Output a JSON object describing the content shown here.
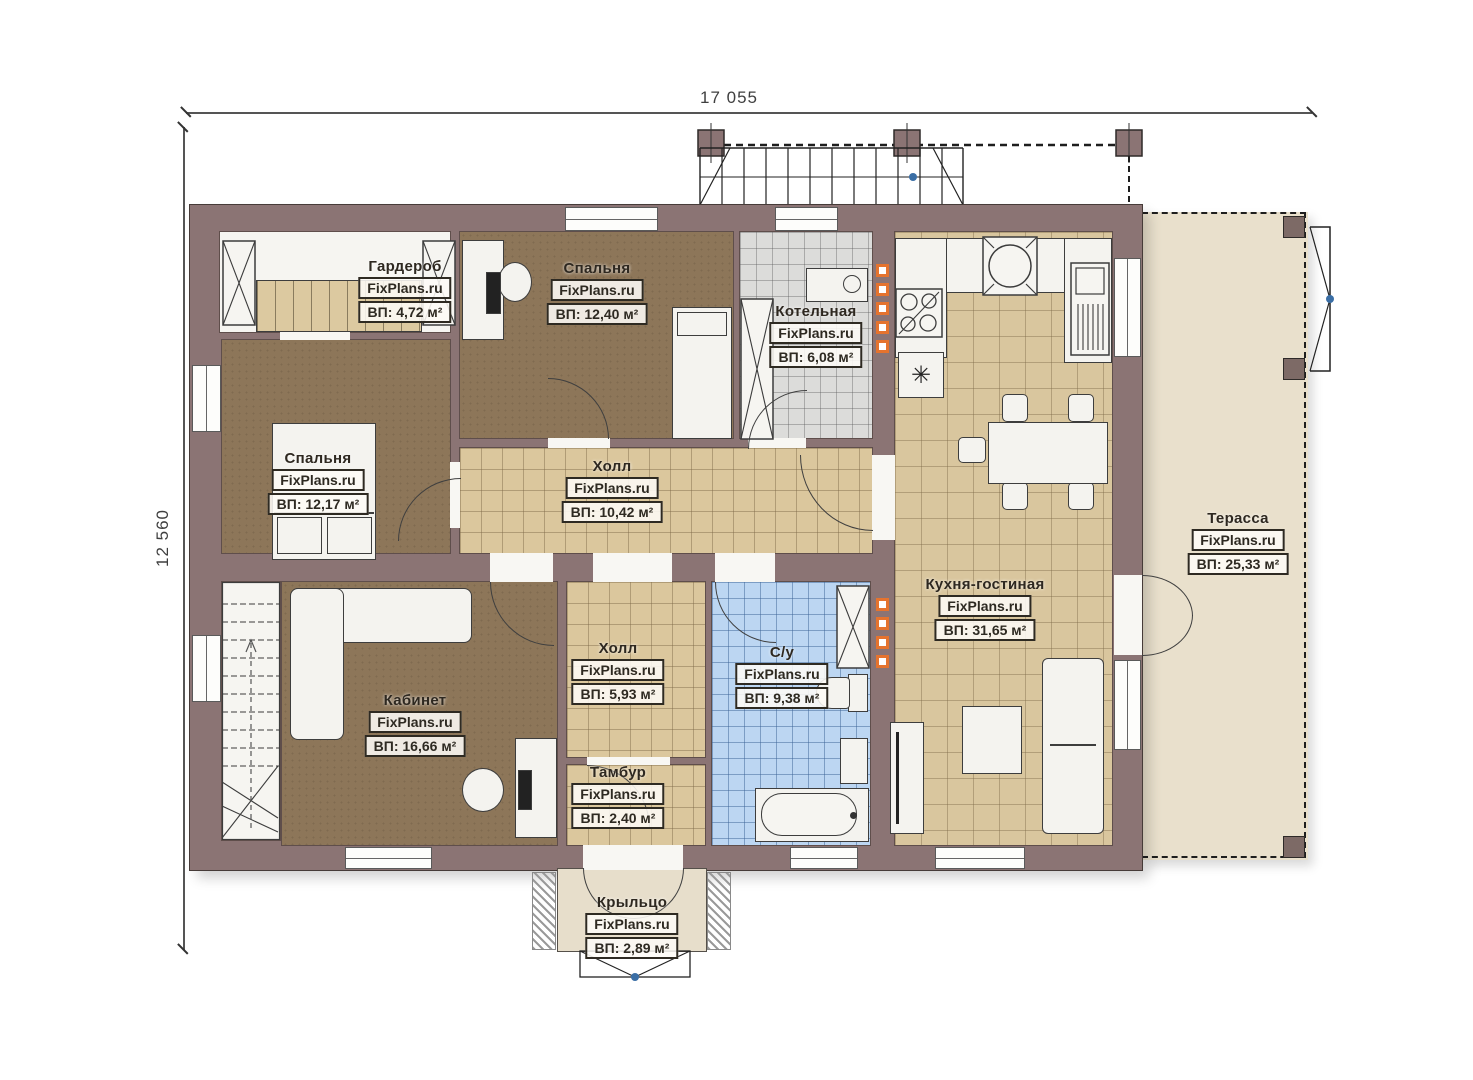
{
  "watermark": "FixPlans.ru",
  "dimensions": {
    "width_label": "17 055",
    "height_label": "12 560"
  },
  "symbols": {
    "freezer_star": "✳"
  },
  "rooms": {
    "wardrobe": {
      "name": "Гардероб",
      "area": "ВП: 4,72 м²"
    },
    "bedroom2": {
      "name": "Спальня",
      "area": "ВП: 12,40 м²"
    },
    "boiler": {
      "name": "Котельная",
      "area": "ВП: 6,08 м²"
    },
    "bedroom1": {
      "name": "Спальня",
      "area": "ВП: 12,17 м²"
    },
    "hall_main": {
      "name": "Холл",
      "area": "ВП: 10,42 м²"
    },
    "kitchen": {
      "name": "Кухня-гостиная",
      "area": "ВП: 31,65 м²"
    },
    "terrace": {
      "name": "Терасса",
      "area": "ВП: 25,33 м²"
    },
    "office": {
      "name": "Кабинет",
      "area": "ВП: 16,66 м²"
    },
    "hall_small": {
      "name": "Холл",
      "area": "ВП: 5,93 м²"
    },
    "bathroom": {
      "name": "С/у",
      "area": "ВП: 9,38 м²"
    },
    "vestibule": {
      "name": "Тамбур",
      "area": "ВП: 2,40 м²"
    },
    "porch": {
      "name": "Крыльцо",
      "area": "ВП: 2,89 м²"
    }
  },
  "colors": {
    "wall": "#8b7474",
    "floor_wood": "#8d7659",
    "tile_beige": "#dbc79d",
    "tile_gray": "#dcdcda",
    "tile_blue": "#bcd6f2",
    "terrace_floor": "#e9e0cc",
    "accent_orange": "#e5732e",
    "marker_blue": "#3a6ea5"
  }
}
